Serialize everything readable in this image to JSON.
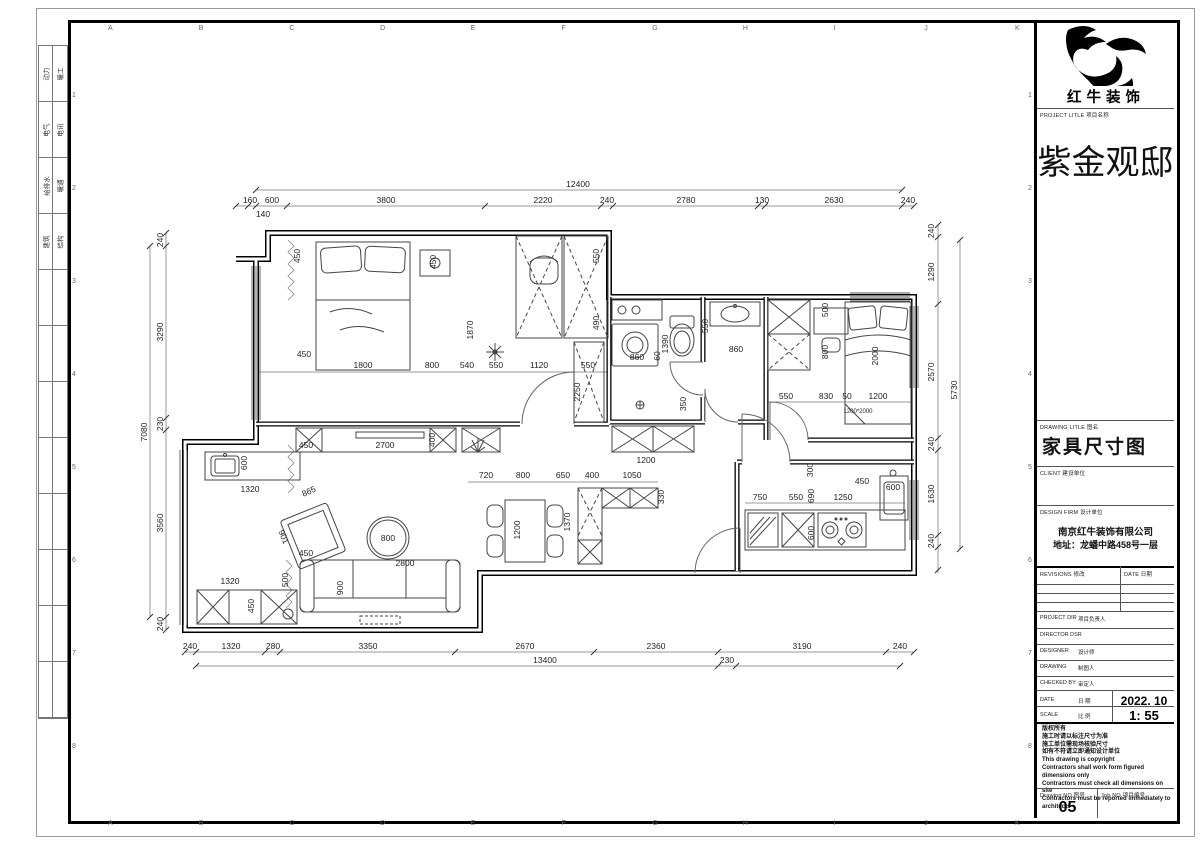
{
  "sheet": {
    "grid_letters": [
      "A",
      "B",
      "C",
      "D",
      "E",
      "F",
      "G",
      "H",
      "I",
      "J",
      "K"
    ],
    "grid_numbers": [
      "1",
      "2",
      "3",
      "4",
      "5",
      "6",
      "7",
      "8"
    ],
    "discipline_rows": [
      [
        "动力",
        "暖工"
      ],
      [
        "电气",
        "电讯"
      ],
      [
        "给排水",
        "暖通"
      ],
      [
        "建筑",
        "结构"
      ]
    ]
  },
  "title_block": {
    "logo_text": "红牛装饰",
    "project_label": "PROJECT LITLE   项目名称",
    "project_name": "紫金观邸",
    "drawing_title_label": "DRAWING LITLE   图名",
    "drawing_title": "家具尺寸图",
    "client_label": "CLIENT   建设单位",
    "design_firm_label": "DESIGN FIRM   设计单位",
    "firm_name": "南京红牛装饰有限公司",
    "firm_address": "地址：龙蟠中路458号一层",
    "revisions_label": "REVISIONS  修改",
    "revisions_date_label": "DATE  日期",
    "rows": [
      {
        "label": "PROJECT DIR",
        "cn": "项目负责人",
        "value": ""
      },
      {
        "label": "DIRECTOR DSR",
        "cn": "",
        "value": ""
      },
      {
        "label": "DESIGNER",
        "cn": "设计师",
        "value": ""
      },
      {
        "label": "DRAWING",
        "cn": "制图人",
        "value": ""
      },
      {
        "label": "CHECKED BY",
        "cn": "审定人",
        "value": ""
      },
      {
        "label": "DATE",
        "cn": "日 期",
        "value": "2022. 10"
      },
      {
        "label": "SCALE",
        "cn": "比 例",
        "value": "1: 55"
      }
    ],
    "notes": [
      "版权所有",
      "施工时请以标注尺寸为准",
      "施工单位需现场核验尺寸",
      "如有不符请立即通知设计单位",
      "This drawing is copyright",
      "Contractors shall work form figured dimensions only",
      "Contractors must check all dimensions on site",
      "Contractors must be reported immediately to architects"
    ],
    "drawing_no_label": "Drawing NO  图号",
    "drawing_no": "05",
    "job_no_label": "Job NO  项目编号"
  },
  "plan": {
    "labels": [
      {
        "t": "12400",
        "x": 578,
        "y": 187
      },
      {
        "t": "160",
        "x": 250,
        "y": 203
      },
      {
        "t": "600",
        "x": 272,
        "y": 203
      },
      {
        "t": "3800",
        "x": 386,
        "y": 203
      },
      {
        "t": "2220",
        "x": 543,
        "y": 203
      },
      {
        "t": "240",
        "x": 607,
        "y": 203
      },
      {
        "t": "2780",
        "x": 686,
        "y": 203
      },
      {
        "t": "130",
        "x": 762,
        "y": 203
      },
      {
        "t": "2630",
        "x": 834,
        "y": 203
      },
      {
        "t": "240",
        "x": 908,
        "y": 203
      },
      {
        "t": "140",
        "x": 263,
        "y": 217
      },
      {
        "t": "240",
        "x": 190,
        "y": 649
      },
      {
        "t": "1320",
        "x": 231,
        "y": 649
      },
      {
        "t": "280",
        "x": 273,
        "y": 649
      },
      {
        "t": "3350",
        "x": 368,
        "y": 649
      },
      {
        "t": "2670",
        "x": 525,
        "y": 649
      },
      {
        "t": "2360",
        "x": 656,
        "y": 649
      },
      {
        "t": "3190",
        "x": 802,
        "y": 649
      },
      {
        "t": "240",
        "x": 900,
        "y": 649
      },
      {
        "t": "13400",
        "x": 545,
        "y": 663
      },
      {
        "t": "230",
        "x": 727,
        "y": 663
      },
      {
        "t": "240",
        "x": 163,
        "y": 240,
        "r": -90
      },
      {
        "t": "3290",
        "x": 163,
        "y": 332,
        "r": -90
      },
      {
        "t": "230",
        "x": 163,
        "y": 424,
        "r": -90
      },
      {
        "t": "3560",
        "x": 163,
        "y": 523,
        "r": -90
      },
      {
        "t": "240",
        "x": 163,
        "y": 624,
        "r": -90
      },
      {
        "t": "7080",
        "x": 147,
        "y": 432,
        "r": -90
      },
      {
        "t": "240",
        "x": 934,
        "y": 231,
        "r": -90
      },
      {
        "t": "1290",
        "x": 934,
        "y": 272,
        "r": -90
      },
      {
        "t": "2570",
        "x": 934,
        "y": 372,
        "r": -90
      },
      {
        "t": "240",
        "x": 934,
        "y": 444,
        "r": -90
      },
      {
        "t": "1630",
        "x": 934,
        "y": 494,
        "r": -90
      },
      {
        "t": "240",
        "x": 934,
        "y": 541,
        "r": -90
      },
      {
        "t": "5730",
        "x": 957,
        "y": 390,
        "r": -90
      },
      {
        "t": "450",
        "x": 304,
        "y": 357
      },
      {
        "t": "1800",
        "x": 363,
        "y": 368
      },
      {
        "t": "800",
        "x": 432,
        "y": 368
      },
      {
        "t": "540",
        "x": 467,
        "y": 368
      },
      {
        "t": "550",
        "x": 496,
        "y": 368
      },
      {
        "t": "1120",
        "x": 539,
        "y": 368
      },
      {
        "t": "550",
        "x": 588,
        "y": 368
      },
      {
        "t": "450",
        "x": 300,
        "y": 256,
        "r": -90
      },
      {
        "t": "450",
        "x": 436,
        "y": 262,
        "r": -90
      },
      {
        "t": "1870",
        "x": 473,
        "y": 330,
        "r": -90
      },
      {
        "t": "550",
        "x": 599,
        "y": 256,
        "r": -90
      },
      {
        "t": "490",
        "x": 599,
        "y": 323,
        "r": -90
      },
      {
        "t": "2250",
        "x": 580,
        "y": 392,
        "r": -90
      },
      {
        "t": "450",
        "x": 306,
        "y": 448
      },
      {
        "t": "2700",
        "x": 385,
        "y": 448
      },
      {
        "t": "400",
        "x": 435,
        "y": 440,
        "r": -90
      },
      {
        "t": "600",
        "x": 247,
        "y": 463,
        "r": -90
      },
      {
        "t": "1320",
        "x": 250,
        "y": 492
      },
      {
        "t": "865",
        "x": 310,
        "y": 494,
        "r": -24
      },
      {
        "t": "901",
        "x": 281,
        "y": 538,
        "r": 66
      },
      {
        "t": "800",
        "x": 388,
        "y": 541
      },
      {
        "t": "450",
        "x": 306,
        "y": 556
      },
      {
        "t": "500",
        "x": 288,
        "y": 580,
        "r": -90
      },
      {
        "t": "2800",
        "x": 405,
        "y": 566
      },
      {
        "t": "900",
        "x": 343,
        "y": 588,
        "r": -90
      },
      {
        "t": "1320",
        "x": 230,
        "y": 584
      },
      {
        "t": "450",
        "x": 254,
        "y": 606,
        "r": -90
      },
      {
        "t": "720",
        "x": 486,
        "y": 478
      },
      {
        "t": "800",
        "x": 523,
        "y": 478
      },
      {
        "t": "650",
        "x": 563,
        "y": 478
      },
      {
        "t": "400",
        "x": 592,
        "y": 478
      },
      {
        "t": "1050",
        "x": 632,
        "y": 478
      },
      {
        "t": "1200",
        "x": 520,
        "y": 530,
        "r": -90
      },
      {
        "t": "1370",
        "x": 570,
        "y": 522,
        "r": -90
      },
      {
        "t": "330",
        "x": 664,
        "y": 497,
        "r": -90
      },
      {
        "t": "860",
        "x": 637,
        "y": 360
      },
      {
        "t": "60",
        "x": 660,
        "y": 356,
        "r": -90
      },
      {
        "t": "1390",
        "x": 668,
        "y": 344,
        "r": -90
      },
      {
        "t": "550",
        "x": 708,
        "y": 326,
        "r": -90
      },
      {
        "t": "860",
        "x": 736,
        "y": 352
      },
      {
        "t": "1200",
        "x": 646,
        "y": 463
      },
      {
        "t": "350",
        "x": 686,
        "y": 404,
        "r": -90
      },
      {
        "t": "500",
        "x": 828,
        "y": 310,
        "r": -90
      },
      {
        "t": "800",
        "x": 828,
        "y": 352,
        "r": -90
      },
      {
        "t": "2000",
        "x": 878,
        "y": 356,
        "r": -90
      },
      {
        "t": "550",
        "x": 786,
        "y": 399
      },
      {
        "t": "830",
        "x": 826,
        "y": 399
      },
      {
        "t": "50",
        "x": 847,
        "y": 399
      },
      {
        "t": "1200",
        "x": 878,
        "y": 399
      },
      {
        "t": "1200*2000",
        "x": 858,
        "y": 413,
        "s": 1
      },
      {
        "t": "300",
        "x": 813,
        "y": 470,
        "r": -90
      },
      {
        "t": "450",
        "x": 862,
        "y": 484
      },
      {
        "t": "750",
        "x": 760,
        "y": 500
      },
      {
        "t": "550",
        "x": 796,
        "y": 500
      },
      {
        "t": "690",
        "x": 814,
        "y": 496,
        "r": -90
      },
      {
        "t": "1250",
        "x": 843,
        "y": 500
      },
      {
        "t": "600",
        "x": 893,
        "y": 490
      },
      {
        "t": "600",
        "x": 814,
        "y": 533,
        "r": -90
      }
    ]
  }
}
